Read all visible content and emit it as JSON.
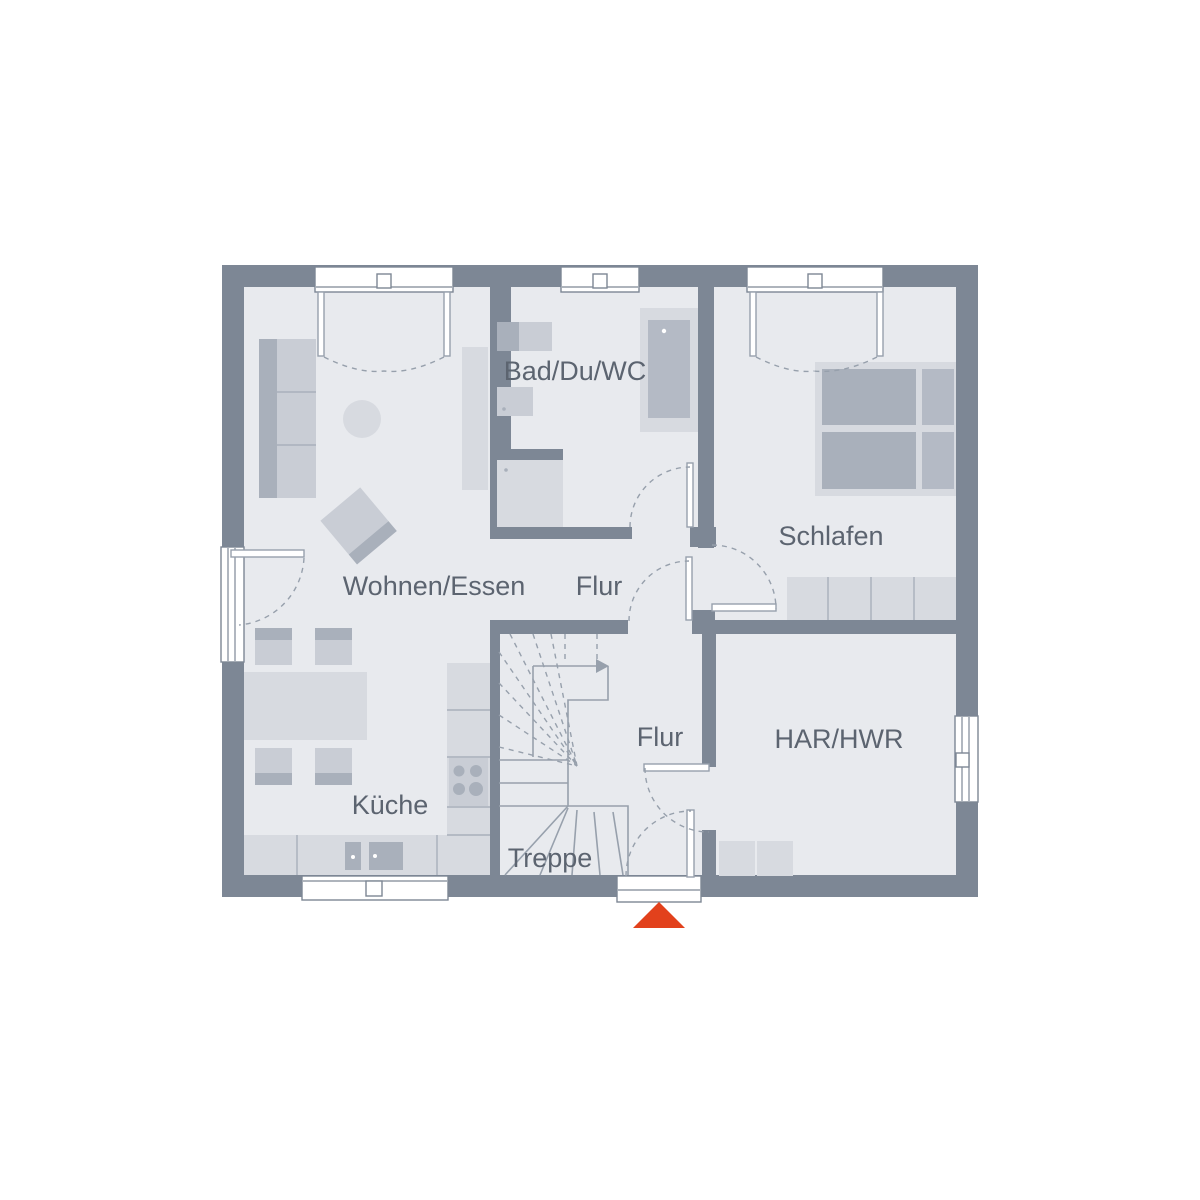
{
  "colors": {
    "wall": "#7d8795",
    "floor": "#e8eaee",
    "window": "#ffffff",
    "line": "#97a0ac",
    "furn-light": "#d7dae0",
    "furn-mid": "#c9cdd5",
    "furn-dark": "#a9b0bb",
    "furn-deep": "#b4bac5",
    "text": "#5c6470",
    "accent": "#e2411c"
  },
  "rooms": {
    "wohnen": {
      "label": "Wohnen/Essen"
    },
    "flur_oben": {
      "label": "Flur"
    },
    "bad": {
      "label": "Bad/Du/WC"
    },
    "schlafen": {
      "label": "Schlafen"
    },
    "kueche": {
      "label": "Küche"
    },
    "flur_unten": {
      "label": "Flur"
    },
    "har": {
      "label": "HAR/HWR"
    },
    "treppe": {
      "label": "Treppe"
    }
  }
}
